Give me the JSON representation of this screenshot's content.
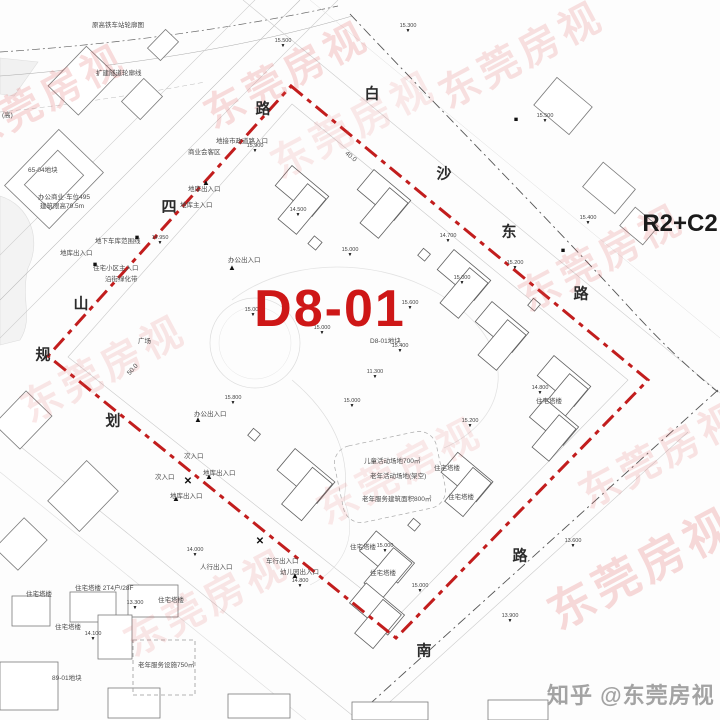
{
  "parcel": {
    "id": "D8-01",
    "zoning": "R2+C2",
    "sub_label": "D8-01地块"
  },
  "credit": {
    "text": "知乎 @东莞房视"
  },
  "watermark_text": "东莞房视",
  "colors": {
    "boundary_red": "#c21d1d",
    "parcel_label_red": "#ce1717",
    "watermark_red": "#e05a5a",
    "credit_gray": "#a3a3a3"
  },
  "roads": [
    {
      "name": "白沙东路",
      "chars": [
        {
          "c": "白",
          "x": 372,
          "y": 93
        },
        {
          "c": "沙",
          "x": 444,
          "y": 173
        },
        {
          "c": "东",
          "x": 509,
          "y": 231
        },
        {
          "c": "路",
          "x": 581,
          "y": 293
        }
      ]
    },
    {
      "name": "山四路",
      "chars": [
        {
          "c": "路",
          "x": 263,
          "y": 108
        },
        {
          "c": "四",
          "x": 169,
          "y": 206
        },
        {
          "c": "山",
          "x": 81,
          "y": 303
        }
      ]
    },
    {
      "name": "规划",
      "chars": [
        {
          "c": "规",
          "x": 43,
          "y": 354
        },
        {
          "c": "划",
          "x": 113,
          "y": 420
        }
      ]
    },
    {
      "name": "南路",
      "chars": [
        {
          "c": "路",
          "x": 520,
          "y": 555
        },
        {
          "c": "南",
          "x": 424,
          "y": 650
        }
      ]
    }
  ],
  "labels": [
    {
      "t": "原高铁车站轮廓图",
      "x": 92,
      "y": 22
    },
    {
      "t": "扩建隧道轮廓线",
      "x": 96,
      "y": 70
    },
    {
      "t": "(高)",
      "x": 2,
      "y": 112
    },
    {
      "t": "65-04地块",
      "x": 28,
      "y": 167
    },
    {
      "t": "办公商业·车位495",
      "x": 38,
      "y": 194
    },
    {
      "t": "建筑限高79.5m",
      "x": 40,
      "y": 203
    },
    {
      "t": "地下车库范围线",
      "x": 95,
      "y": 238
    },
    {
      "t": "地库出入口",
      "x": 60,
      "y": 250
    },
    {
      "t": "住宅小区主入口",
      "x": 93,
      "y": 265
    },
    {
      "t": "沿街绿化带",
      "x": 105,
      "y": 276
    },
    {
      "t": "地接市政道路入口",
      "x": 216,
      "y": 138
    },
    {
      "t": "商业会客区",
      "x": 188,
      "y": 149
    },
    {
      "t": "地库出入口",
      "x": 188,
      "y": 186
    },
    {
      "t": "地库主入口",
      "x": 180,
      "y": 202
    },
    {
      "t": "办公出入口",
      "x": 228,
      "y": 257
    },
    {
      "t": "办公出入口",
      "x": 194,
      "y": 411
    },
    {
      "t": "地库出入口",
      "x": 203,
      "y": 470
    },
    {
      "t": "次入口",
      "x": 184,
      "y": 453
    },
    {
      "t": "次入口",
      "x": 155,
      "y": 474
    },
    {
      "t": "地库出入口",
      "x": 170,
      "y": 493
    },
    {
      "t": "人行出入口",
      "x": 200,
      "y": 564
    },
    {
      "t": "车行出入口",
      "x": 266,
      "y": 558
    },
    {
      "t": "幼儿园出入口",
      "x": 280,
      "y": 569
    },
    {
      "t": "儿童活动场地700㎡",
      "x": 364,
      "y": 458
    },
    {
      "t": "老年活动场地(架空)",
      "x": 370,
      "y": 473
    },
    {
      "t": "老年服务建筑面积800㎡",
      "x": 362,
      "y": 496
    },
    {
      "t": "老年服务设施750㎡",
      "x": 138,
      "y": 662
    },
    {
      "t": "89-01地块",
      "x": 52,
      "y": 675
    },
    {
      "t": "D8-01地块",
      "x": 370,
      "y": 338
    },
    {
      "t": "广场",
      "x": 138,
      "y": 338
    },
    {
      "t": "住宅塔楼",
      "x": 26,
      "y": 591
    },
    {
      "t": "住宅塔楼",
      "x": 158,
      "y": 597
    },
    {
      "t": "住宅塔楼",
      "x": 55,
      "y": 624
    },
    {
      "t": "住宅塔楼",
      "x": 434,
      "y": 465
    },
    {
      "t": "住宅塔楼",
      "x": 448,
      "y": 494
    },
    {
      "t": "住宅塔楼",
      "x": 350,
      "y": 544
    },
    {
      "t": "住宅塔楼",
      "x": 370,
      "y": 570
    },
    {
      "t": "住宅塔楼",
      "x": 536,
      "y": 398
    },
    {
      "t": "住宅塔楼 2T4户/28F",
      "x": 75,
      "y": 585
    },
    {
      "t": "40.0",
      "x": 348,
      "y": 150,
      "r": 40
    },
    {
      "t": "50.0",
      "x": 126,
      "y": 372,
      "r": -48
    }
  ],
  "elevations": [
    {
      "v": "15.500",
      "x": 283,
      "y": 43
    },
    {
      "v": "15.300",
      "x": 408,
      "y": 28
    },
    {
      "v": "15.500",
      "x": 545,
      "y": 118
    },
    {
      "v": "15.400",
      "x": 588,
      "y": 220
    },
    {
      "v": "15.900",
      "x": 255,
      "y": 148
    },
    {
      "v": "14.500",
      "x": 298,
      "y": 212
    },
    {
      "v": "14.950",
      "x": 160,
      "y": 240
    },
    {
      "v": "15.000",
      "x": 350,
      "y": 252
    },
    {
      "v": "15.200",
      "x": 515,
      "y": 265
    },
    {
      "v": "15.000",
      "x": 462,
      "y": 280
    },
    {
      "v": "14.700",
      "x": 448,
      "y": 238
    },
    {
      "v": "15.000",
      "x": 253,
      "y": 312
    },
    {
      "v": "15.000",
      "x": 322,
      "y": 330
    },
    {
      "v": "15.600",
      "x": 410,
      "y": 305
    },
    {
      "v": "15.400",
      "x": 400,
      "y": 348
    },
    {
      "v": "11.300",
      "x": 375,
      "y": 374
    },
    {
      "v": "15.800",
      "x": 233,
      "y": 400
    },
    {
      "v": "15.000",
      "x": 352,
      "y": 403
    },
    {
      "v": "15.200",
      "x": 470,
      "y": 423
    },
    {
      "v": "14.800",
      "x": 540,
      "y": 390
    },
    {
      "v": "13.600",
      "x": 573,
      "y": 543
    },
    {
      "v": "14.000",
      "x": 195,
      "y": 552
    },
    {
      "v": "15.000",
      "x": 385,
      "y": 548
    },
    {
      "v": "14.800",
      "x": 300,
      "y": 583
    },
    {
      "v": "15.000",
      "x": 420,
      "y": 588
    },
    {
      "v": "13.300",
      "x": 135,
      "y": 605
    },
    {
      "v": "14.100",
      "x": 93,
      "y": 636
    },
    {
      "v": "13.900",
      "x": 510,
      "y": 618
    }
  ],
  "markers": [
    {
      "g": "tri",
      "x": 206,
      "y": 183
    },
    {
      "g": "tri",
      "x": 232,
      "y": 268
    },
    {
      "g": "tri",
      "x": 198,
      "y": 420
    },
    {
      "g": "tri",
      "x": 209,
      "y": 477
    },
    {
      "g": "tri",
      "x": 176,
      "y": 499
    },
    {
      "g": "tri",
      "x": 295,
      "y": 576
    },
    {
      "g": "sq",
      "x": 137,
      "y": 238
    },
    {
      "g": "sq",
      "x": 95,
      "y": 265
    },
    {
      "g": "sq",
      "x": 563,
      "y": 251
    },
    {
      "g": "sq",
      "x": 516,
      "y": 120
    },
    {
      "g": "x",
      "x": 188,
      "y": 482
    },
    {
      "g": "x",
      "x": 260,
      "y": 542
    }
  ],
  "watermarks": [
    {
      "x": 285,
      "y": 72,
      "s": 40,
      "o": 0.2
    },
    {
      "x": 520,
      "y": 52,
      "s": 40,
      "o": 0.18
    },
    {
      "x": 42,
      "y": 95,
      "s": 40,
      "o": 0.2
    },
    {
      "x": 600,
      "y": 255,
      "s": 40,
      "o": 0.18
    },
    {
      "x": 102,
      "y": 366,
      "s": 40,
      "o": 0.14
    },
    {
      "x": 352,
      "y": 122,
      "s": 40,
      "o": 0.12
    },
    {
      "x": 205,
      "y": 600,
      "s": 40,
      "o": 0.14
    },
    {
      "x": 640,
      "y": 566,
      "s": 46,
      "o": 0.22
    },
    {
      "x": 398,
      "y": 468,
      "s": 40,
      "o": 0.12
    },
    {
      "x": 660,
      "y": 452,
      "s": 40,
      "o": 0.16
    }
  ]
}
